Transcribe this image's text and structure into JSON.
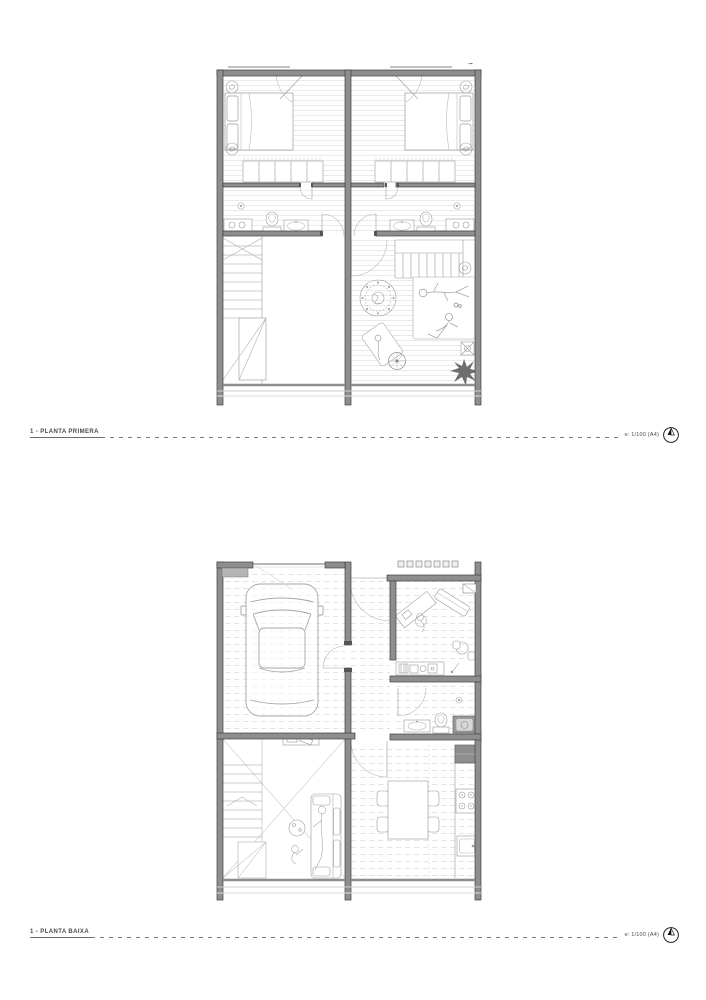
{
  "page": {
    "background": "#ffffff"
  },
  "figures": [
    {
      "id": "planta-primera",
      "label": "1 - PLANTA PRIMERA",
      "scale_note": "e: 1/100 (A4)"
    },
    {
      "id": "planta-baixa",
      "label": "1 - PLANTA BAIXA",
      "scale_note": "e: 1/100 (A4)"
    }
  ],
  "icons": {
    "north_compass": "circle with filled north needle"
  },
  "colors": {
    "wall_fill": "#8e8e8e",
    "wall_stroke": "#3f3f3f",
    "furniture_line": "#9a9a9a",
    "hatch_line": "#d8d8d8",
    "door_arc": "#b8b8b8",
    "label_text": "#4a4a4a"
  }
}
